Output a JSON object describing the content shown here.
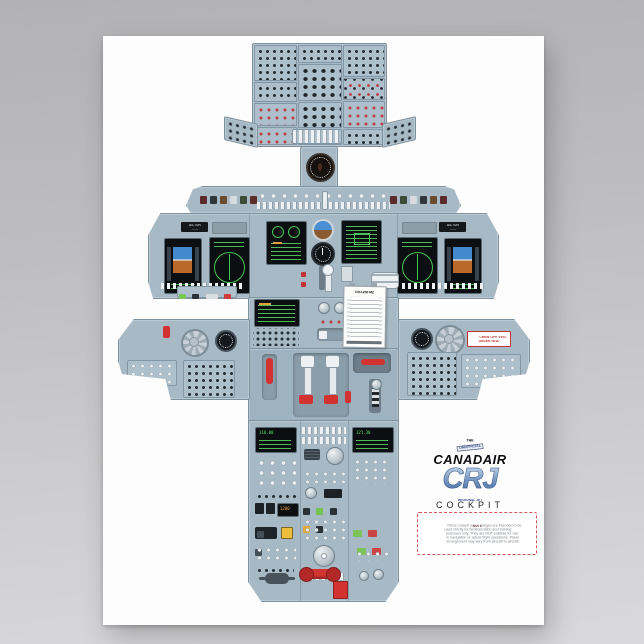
{
  "brand": {
    "the": "THE",
    "banner": "UNOFFICIAL",
    "name": "CANADAIR",
    "model": "CRJ",
    "model_sub": "REGIONAL JET"
  },
  "title": "COCKPIT",
  "credit": {
    "pre": "illustrated by",
    "author": "MIKE RAY",
    "sub": "captain (ret.)",
    "copyright": "© MIKE RAY"
  },
  "note": {
    "title": "NOTE",
    "lines": [
      "These cockpit panel images are intended to be",
      "used strictly for familiarization and training",
      "purposes only. They are NOT suitable for use",
      "in navigation or actual flight operations. Panel",
      "arrangement may vary from aircraft to aircraft."
    ]
  },
  "placards": {
    "aircraft_id": "A/C S/N",
    "life_vest": "CREW LIFE VEST",
    "life_vest2": "UNDER SEAT",
    "checklist": "CRJ-200 M2"
  },
  "displays": {
    "radio_left": "118.00",
    "radio_right": "121.30",
    "atc": "1200"
  },
  "colors": {
    "panel_blue_gray": "#a7b9c5",
    "screen_green": "#57e065",
    "warning_red": "#d23331",
    "logo_blue": "#7d9cc4",
    "amber": "#f0a63c"
  }
}
